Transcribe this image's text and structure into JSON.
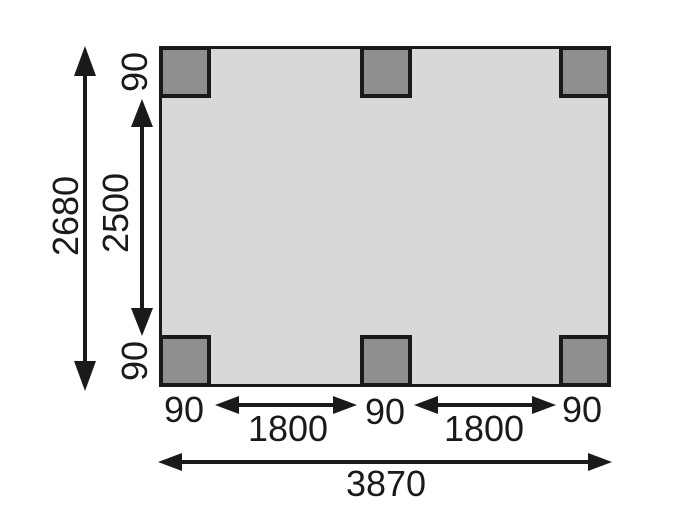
{
  "diagram": {
    "type": "floor-plan-dimension-drawing",
    "colors": {
      "background": "#ffffff",
      "floor_fill": "#d8d8d8",
      "post_fill": "#8f8f8f",
      "line": "#1a1a1a"
    },
    "posts": [
      "top-left",
      "top-middle",
      "top-right",
      "bottom-left",
      "bottom-middle",
      "bottom-right"
    ],
    "labels": {
      "overall_depth": "2680",
      "inner_depth": "2500",
      "post_depth_top": "90",
      "post_depth_bottom": "90",
      "post_width_left": "90",
      "bay_left": "1800",
      "post_width_middle": "90",
      "bay_right": "1800",
      "post_width_right": "90",
      "overall_width": "3870"
    }
  }
}
